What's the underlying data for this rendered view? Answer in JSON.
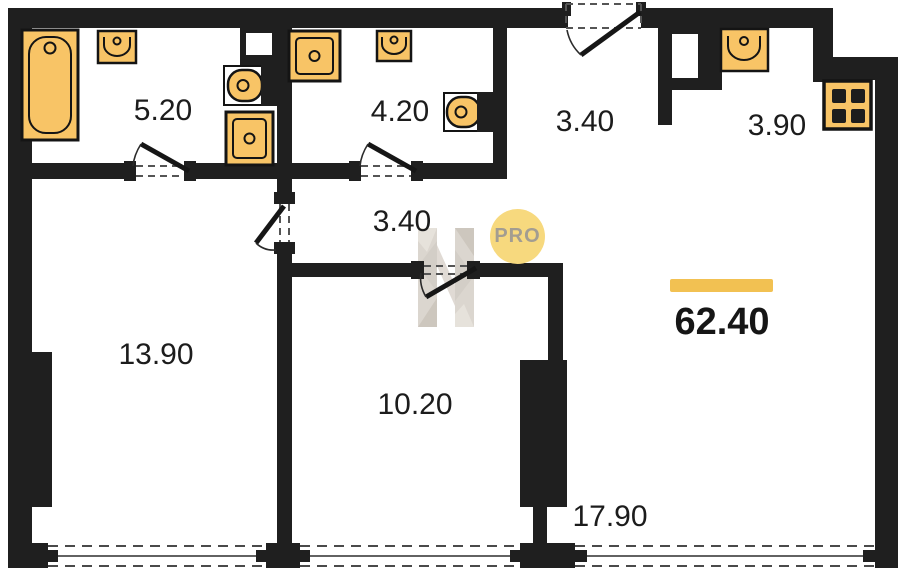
{
  "badge": {
    "label": "PRO"
  },
  "total": {
    "area": "62.40"
  },
  "rooms": [
    {
      "name": "bathroom",
      "area": "5.20"
    },
    {
      "name": "bathroom-2",
      "area": "4.20"
    },
    {
      "name": "hallway",
      "area": "3.40"
    },
    {
      "name": "kitchen-niche",
      "area": "3.90"
    },
    {
      "name": "corridor",
      "area": "3.40"
    },
    {
      "name": "room-left",
      "area": "13.90"
    },
    {
      "name": "room-middle",
      "area": "10.20"
    },
    {
      "name": "living-room",
      "area": "17.90"
    }
  ],
  "fixtures": [
    "bathtub",
    "washbasin",
    "toilet",
    "washing-machine",
    "shower-tray",
    "washbasin",
    "toilet",
    "kitchen-sink",
    "stove"
  ],
  "colors": {
    "wall": "#1f1f1f",
    "fixture_fill": "#f8c466",
    "accent_bar": "#f2c152",
    "badge_fill": "#f7d97e",
    "badge_text": "#a39d91",
    "watermark": "#d8d2ca"
  }
}
